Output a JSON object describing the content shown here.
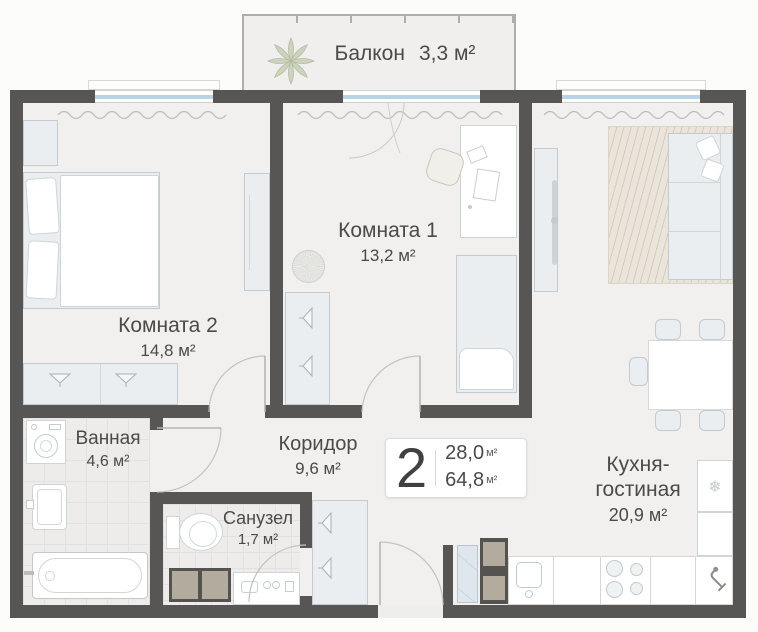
{
  "rooms": {
    "balcony": {
      "name": "Балкон",
      "area": "3,3 м²"
    },
    "room1": {
      "name": "Комната 1",
      "area": "13,2 м²"
    },
    "room2": {
      "name": "Комната 2",
      "area": "14,8 м²"
    },
    "bathroom": {
      "name": "Ванная",
      "area": "4,6 м²"
    },
    "corridor": {
      "name": "Коридор",
      "area": "9,6 м²"
    },
    "wc": {
      "name": "Санузел",
      "area": "1,7 м²"
    },
    "kitchen_living": {
      "name": "Кухня-гостиная",
      "area": "20,9 м²"
    }
  },
  "info_plate": {
    "rooms_count": "2",
    "area_living": "28,0",
    "area_total": "64,8",
    "unit": "м²"
  },
  "icons": {
    "snowflake": "❄"
  },
  "colors": {
    "wall": "#575654",
    "floor": "#f1f0ee",
    "window_glass": "#b7d3e6",
    "plant": "#ccd4bf",
    "kitchen_rug": "#ebe4da",
    "text": "#4a4a4a"
  }
}
